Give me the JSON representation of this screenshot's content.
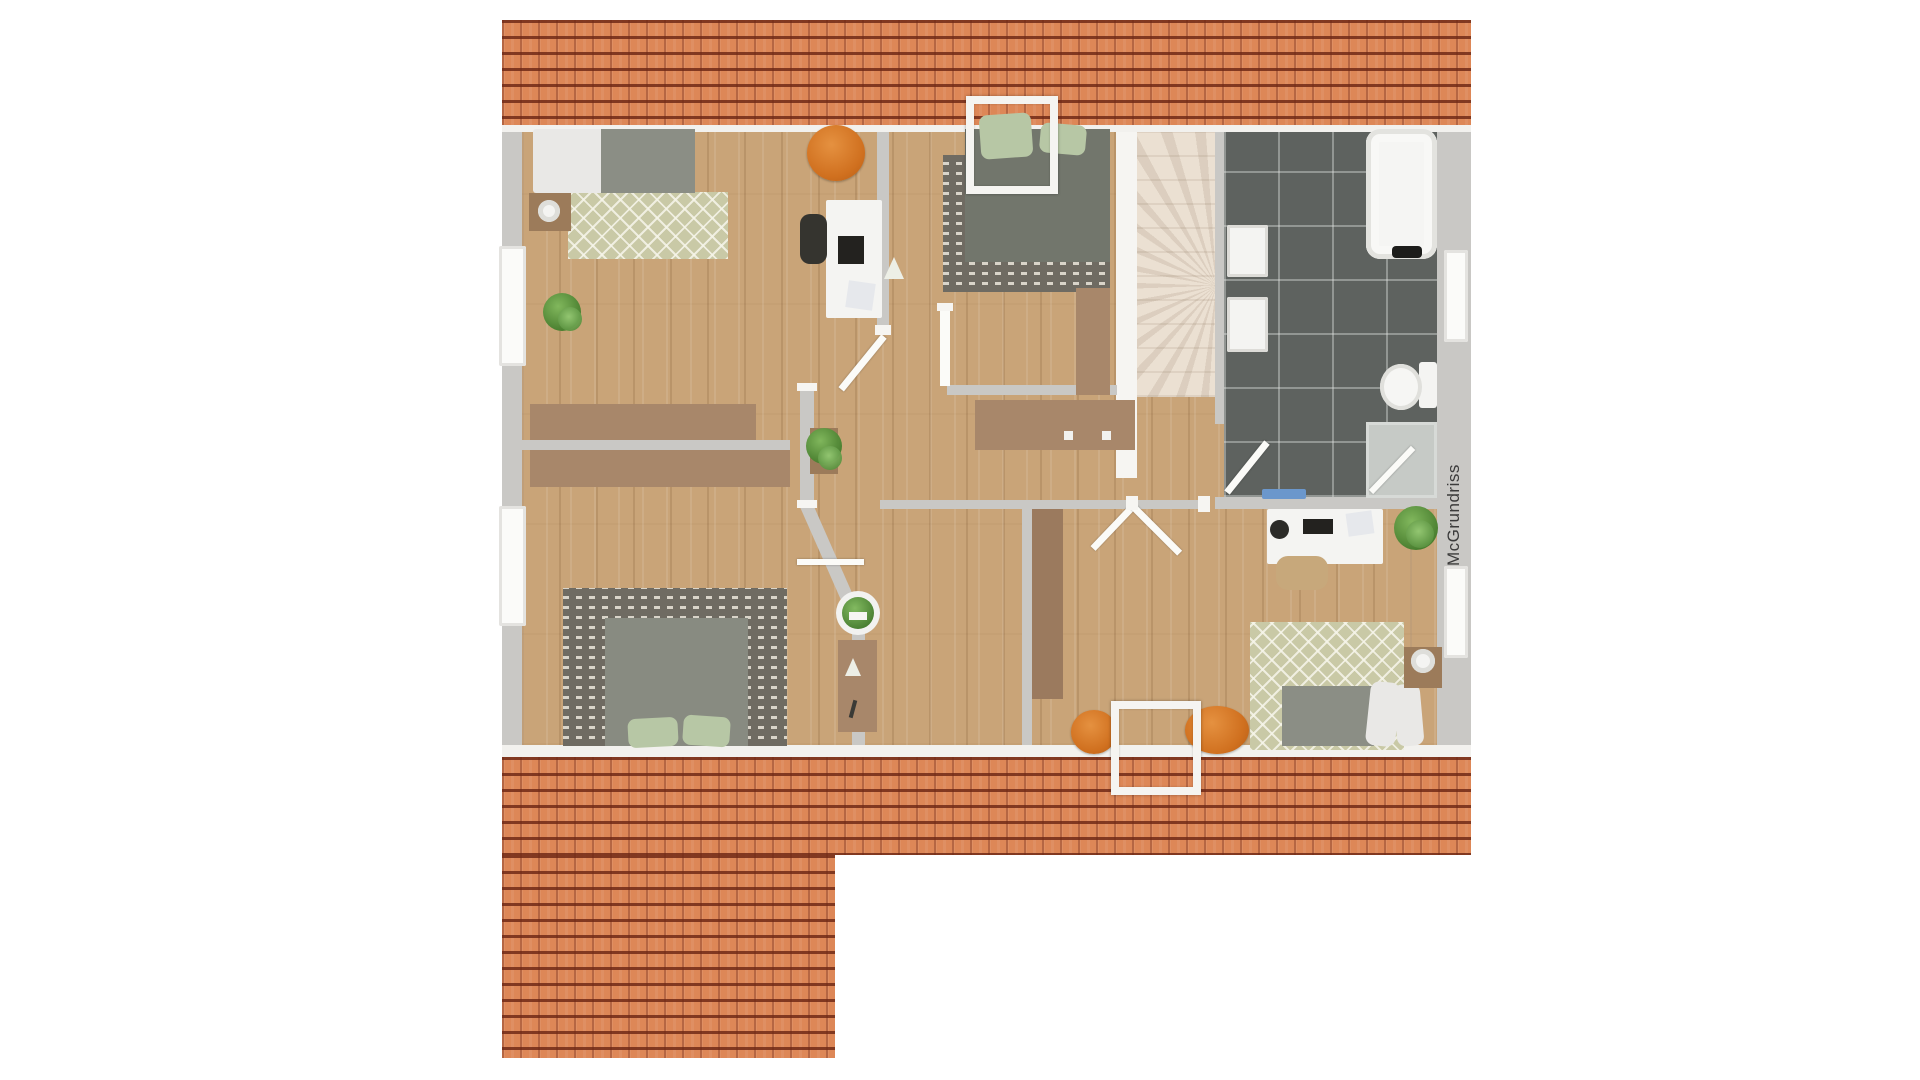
{
  "watermark": {
    "text": "McGrundriss"
  },
  "palette": {
    "background": "#ffffff",
    "roof_tile_orange": "#dd8757",
    "roof_line_dark": "#6d2614",
    "wall_gray": "#c9c8c5",
    "trim_white": "#f2f1ee",
    "wood_floor": "#c9a478",
    "furniture_wood": "#a8876a",
    "bath_tile_dark": "#5e625f",
    "stairs_cream": "#ebe0d2",
    "rug_green": "#c9c9a6",
    "rug_dark": "#6f6b62",
    "mattress_gray": "#8b8e85",
    "pillow_green": "#b7c7a5",
    "accent_orange_pouf": "#d0701f",
    "plant_green": "#447c2c",
    "bathmat_blue": "#6b97cc",
    "watermark_text": "#3b3b3b"
  },
  "scene": {
    "w": 1920,
    "h": 1080,
    "items": [
      {
        "t": "rect",
        "n": "roof-top",
        "x": 502,
        "y": 20,
        "w": 969,
        "h": 105,
        "c": "roof"
      },
      {
        "t": "rect",
        "n": "roof-top-trim",
        "x": 502,
        "y": 125,
        "w": 969,
        "h": 8,
        "f": "#f2f1ee"
      },
      {
        "t": "rect",
        "n": "floor-base",
        "x": 522,
        "y": 132,
        "w": 915,
        "h": 613,
        "c": "wood"
      },
      {
        "t": "rect",
        "n": "outer-wall-left",
        "x": 502,
        "y": 132,
        "w": 20,
        "h": 613,
        "c": "wall"
      },
      {
        "t": "rect",
        "n": "outer-wall-right",
        "x": 1437,
        "y": 132,
        "w": 34,
        "h": 613,
        "c": "wall"
      },
      {
        "t": "rect",
        "n": "floor-bottom-trim",
        "x": 502,
        "y": 745,
        "w": 969,
        "h": 12,
        "f": "#f2f1ee"
      },
      {
        "t": "rect",
        "n": "roof-bottom",
        "x": 502,
        "y": 757,
        "w": 969,
        "h": 98,
        "c": "roof"
      },
      {
        "t": "rect",
        "n": "roof-bottom-left-wing",
        "x": 502,
        "y": 855,
        "w": 333,
        "h": 203,
        "c": "roof"
      },
      {
        "t": "rect",
        "n": "staircase",
        "x": 1137,
        "y": 132,
        "w": 78,
        "h": 265,
        "c": "stairs"
      },
      {
        "t": "rect",
        "n": "stairs-side-wall",
        "x": 1116,
        "y": 132,
        "w": 21,
        "h": 346,
        "f": "#f6f5f2"
      },
      {
        "t": "rect",
        "n": "bathroom-floor",
        "x": 1224,
        "y": 132,
        "w": 213,
        "h": 365,
        "c": "tiles"
      },
      {
        "t": "rect",
        "n": "bathroom-wall-left",
        "x": 1215,
        "y": 132,
        "w": 9,
        "h": 292,
        "c": "wall"
      },
      {
        "t": "rect",
        "n": "bathroom-wall-bottom",
        "x": 1215,
        "y": 497,
        "w": 222,
        "h": 12,
        "c": "wall"
      },
      {
        "t": "rect",
        "n": "wall-bedroom1-right",
        "x": 877,
        "y": 132,
        "w": 12,
        "h": 200,
        "c": "wall"
      },
      {
        "t": "rect",
        "n": "wall-divider-left",
        "x": 522,
        "y": 440,
        "w": 268,
        "h": 10,
        "c": "wall"
      },
      {
        "t": "rect",
        "n": "wall-hall-mid",
        "x": 800,
        "y": 390,
        "w": 14,
        "h": 116,
        "c": "wall"
      },
      {
        "t": "line",
        "n": "wall-hall-angled",
        "x1": 806,
        "y1": 504,
        "x2": 858,
        "y2": 622,
        "sw": 13,
        "f": "#c9c8c5"
      },
      {
        "t": "rect",
        "n": "wall-hall-low",
        "x": 852,
        "y": 620,
        "w": 13,
        "h": 125,
        "c": "wall"
      },
      {
        "t": "rect",
        "n": "wall-bottom-rooms-top",
        "x": 880,
        "y": 500,
        "w": 330,
        "h": 9,
        "c": "wall"
      },
      {
        "t": "rect",
        "n": "wall-midroom-right",
        "x": 1022,
        "y": 509,
        "w": 10,
        "h": 236,
        "c": "wall"
      },
      {
        "t": "rect",
        "n": "wall-bedroom2-bottom",
        "x": 947,
        "y": 385,
        "w": 170,
        "h": 10,
        "c": "wall"
      },
      {
        "t": "rect",
        "n": "window-left-1",
        "x": 499,
        "y": 246,
        "w": 27,
        "h": 120,
        "c": "win"
      },
      {
        "t": "rect",
        "n": "window-left-2",
        "x": 499,
        "y": 506,
        "w": 27,
        "h": 120,
        "c": "win"
      },
      {
        "t": "rect",
        "n": "window-right-1",
        "x": 1444,
        "y": 250,
        "w": 24,
        "h": 92,
        "c": "win"
      },
      {
        "t": "rect",
        "n": "window-right-2",
        "x": 1444,
        "y": 566,
        "w": 24,
        "h": 92,
        "c": "win"
      },
      {
        "t": "rect",
        "n": "rug-bedroom1",
        "x": 568,
        "y": 192,
        "w": 160,
        "h": 67,
        "c": "rug-green"
      },
      {
        "t": "rect",
        "n": "bed1-duvet",
        "x": 533,
        "y": 129,
        "w": 70,
        "h": 64,
        "f": "#e9e8e6",
        "rx": 3
      },
      {
        "t": "rect",
        "n": "bed1-mattress",
        "x": 601,
        "y": 129,
        "w": 94,
        "h": 64,
        "f": "#8b8e85"
      },
      {
        "t": "rect",
        "n": "nightstand1",
        "x": 529,
        "y": 193,
        "w": 42,
        "h": 38,
        "f": "#9c7b5a"
      },
      {
        "t": "rect",
        "n": "lamp1",
        "x": 538,
        "y": 200,
        "w": 22,
        "h": 22,
        "c": "lamp",
        "rx": "50%"
      },
      {
        "t": "rect",
        "n": "plant1",
        "x": 543,
        "y": 293,
        "w": 38,
        "h": 38,
        "c": "plantball",
        "rx": "50%"
      },
      {
        "t": "rect",
        "n": "plant1-b",
        "x": 558,
        "y": 307,
        "w": 24,
        "h": 24,
        "c": "plantball2",
        "rx": "50%"
      },
      {
        "t": "rect",
        "n": "pouf1",
        "x": 807,
        "y": 125,
        "w": 58,
        "h": 56,
        "c": "pouf",
        "rx": "50%"
      },
      {
        "t": "rect",
        "n": "desk1",
        "x": 826,
        "y": 200,
        "w": 56,
        "h": 118,
        "f": "#f4f4f2",
        "rx": 2
      },
      {
        "t": "rect",
        "n": "chair1",
        "x": 800,
        "y": 214,
        "w": 27,
        "h": 50,
        "f": "#35342f",
        "rx": 10
      },
      {
        "t": "rect",
        "n": "laptop1",
        "x": 838,
        "y": 236,
        "w": 26,
        "h": 28,
        "f": "#23221f"
      },
      {
        "t": "tri",
        "n": "desk1-deco-triangle",
        "x": 884,
        "y": 257,
        "w": 20,
        "h": 22,
        "f": "#edefe6"
      },
      {
        "t": "rect",
        "n": "desk1-magazine",
        "x": 847,
        "y": 282,
        "w": 27,
        "h": 27,
        "f": "#e6e8ec",
        "rot": 8
      },
      {
        "t": "rect",
        "n": "rug-bedroom2",
        "x": 943,
        "y": 155,
        "w": 167,
        "h": 137,
        "c": "rug-dark"
      },
      {
        "t": "rect",
        "n": "bed2-mattress",
        "x": 965,
        "y": 129,
        "w": 145,
        "h": 133,
        "f": "#72766c"
      },
      {
        "t": "rect",
        "n": "bed2-pillow-a",
        "x": 980,
        "y": 114,
        "w": 52,
        "h": 44,
        "f": "#b7c7a5",
        "rx": 8,
        "rot": -4
      },
      {
        "t": "rect",
        "n": "bed2-pillow-b",
        "x": 1040,
        "y": 124,
        "w": 46,
        "h": 30,
        "f": "#b7c7a5",
        "rx": 8,
        "rot": 5
      },
      {
        "t": "rect",
        "n": "wardrobe2",
        "x": 1076,
        "y": 288,
        "w": 34,
        "h": 107,
        "f": "#a8876a"
      },
      {
        "t": "rect",
        "n": "door2-leaf",
        "x": 940,
        "y": 308,
        "w": 10,
        "h": 78,
        "f": "#fbfbf8"
      },
      {
        "t": "rect",
        "n": "hall-sideboard",
        "x": 975,
        "y": 400,
        "w": 160,
        "h": 50,
        "f": "#a8876a"
      },
      {
        "t": "rect",
        "n": "sideboard-knob-1",
        "x": 1064,
        "y": 431,
        "w": 9,
        "h": 9,
        "f": "#f1f1ee"
      },
      {
        "t": "rect",
        "n": "sideboard-knob-2",
        "x": 1102,
        "y": 431,
        "w": 9,
        "h": 9,
        "f": "#f1f1ee"
      },
      {
        "t": "rect",
        "n": "wardrobe-divider-top",
        "x": 530,
        "y": 404,
        "w": 226,
        "h": 36,
        "f": "#a8876a"
      },
      {
        "t": "rect",
        "n": "wardrobe-divider-bottom",
        "x": 530,
        "y": 450,
        "w": 260,
        "h": 37,
        "f": "#a8876a"
      },
      {
        "t": "rect",
        "n": "rug-bedroom3",
        "x": 563,
        "y": 588,
        "w": 224,
        "h": 158,
        "c": "rug-dark"
      },
      {
        "t": "rect",
        "n": "bed3-mattress",
        "x": 605,
        "y": 618,
        "w": 143,
        "h": 128,
        "f": "#888b81"
      },
      {
        "t": "rect",
        "n": "bed3-pillow-a",
        "x": 628,
        "y": 718,
        "w": 50,
        "h": 29,
        "f": "#b7c7a5",
        "rx": 8,
        "rot": -3
      },
      {
        "t": "rect",
        "n": "bed3-pillow-b",
        "x": 683,
        "y": 716,
        "w": 47,
        "h": 30,
        "f": "#b7c7a5",
        "rx": 8,
        "rot": 4
      },
      {
        "t": "rect",
        "n": "desk3",
        "x": 838,
        "y": 640,
        "w": 39,
        "h": 92,
        "f": "#a8876a"
      },
      {
        "t": "tri",
        "n": "desk3-deco-triangle",
        "x": 845,
        "y": 658,
        "w": 16,
        "h": 18,
        "f": "#edefe6"
      },
      {
        "t": "rect",
        "n": "desk3-pen",
        "x": 851,
        "y": 700,
        "w": 4,
        "h": 18,
        "f": "#3a3a36",
        "rot": 15
      },
      {
        "t": "rect",
        "n": "plant3-pot",
        "x": 836,
        "y": 591,
        "w": 44,
        "h": 44,
        "f": "#f2f2f0",
        "rx": "50%"
      },
      {
        "t": "rect",
        "n": "plant3",
        "x": 842,
        "y": 597,
        "w": 32,
        "h": 32,
        "c": "plantball",
        "rx": "50%"
      },
      {
        "t": "rect",
        "n": "hall-planter",
        "x": 810,
        "y": 428,
        "w": 28,
        "h": 46,
        "f": "#9c7b5a"
      },
      {
        "t": "rect",
        "n": "hall-plant",
        "x": 806,
        "y": 428,
        "w": 36,
        "h": 36,
        "c": "plantball",
        "rx": "50%"
      },
      {
        "t": "rect",
        "n": "hall-plant-b",
        "x": 818,
        "y": 446,
        "w": 24,
        "h": 24,
        "c": "plantball2",
        "rx": "50%"
      },
      {
        "t": "rect",
        "n": "wardrobe-midroom",
        "x": 1032,
        "y": 509,
        "w": 31,
        "h": 190,
        "f": "#9b7a5e"
      },
      {
        "t": "rect",
        "n": "bath-sink-1",
        "x": 1227,
        "y": 225,
        "w": 41,
        "h": 52,
        "c": "sink"
      },
      {
        "t": "rect",
        "n": "bath-sink-2",
        "x": 1227,
        "y": 297,
        "w": 41,
        "h": 55,
        "c": "sink"
      },
      {
        "t": "rect",
        "n": "bathtub",
        "x": 1366,
        "y": 129,
        "w": 71,
        "h": 130,
        "c": "tub"
      },
      {
        "t": "rect",
        "n": "bathtub-headrest",
        "x": 1392,
        "y": 246,
        "w": 30,
        "h": 12,
        "f": "#1d1d1b",
        "rx": 4
      },
      {
        "t": "rect",
        "n": "toilet-tank",
        "x": 1419,
        "y": 362,
        "w": 18,
        "h": 46,
        "f": "#f4f4f2",
        "rx": 3
      },
      {
        "t": "rect",
        "n": "toilet-bowl",
        "x": 1380,
        "y": 364,
        "w": 42,
        "h": 46,
        "f": "#f6f6f4",
        "c": "bowl",
        "rx": "50%"
      },
      {
        "t": "rect",
        "n": "shower",
        "x": 1366,
        "y": 422,
        "w": 71,
        "h": 76,
        "c": "shower"
      },
      {
        "t": "line",
        "n": "shower-door",
        "x1": 1371,
        "y1": 492,
        "x2": 1413,
        "y2": 448,
        "sw": 6
      },
      {
        "t": "rect",
        "n": "bath-mat",
        "x": 1262,
        "y": 489,
        "w": 44,
        "h": 10,
        "f": "#6b97cc",
        "rx": 2
      },
      {
        "t": "line",
        "n": "bathroom-door",
        "x1": 1227,
        "y1": 492,
        "x2": 1267,
        "y2": 442,
        "sw": 7
      },
      {
        "t": "line",
        "n": "bedroom1-door",
        "x1": 884,
        "y1": 336,
        "x2": 841,
        "y2": 389,
        "sw": 7
      },
      {
        "t": "line",
        "n": "hall-door-open",
        "x1": 797,
        "y1": 562,
        "x2": 864,
        "y2": 562,
        "sw": 6
      },
      {
        "t": "line",
        "n": "midroom-door",
        "x1": 1133,
        "y1": 506,
        "x2": 1093,
        "y2": 548,
        "sw": 7
      },
      {
        "t": "line",
        "n": "rightroom-door",
        "x1": 1133,
        "y1": 506,
        "x2": 1180,
        "y2": 553,
        "sw": 7
      },
      {
        "t": "rect",
        "n": "jamb-cap-1",
        "x": 875,
        "y": 325,
        "w": 16,
        "h": 10,
        "c": "cap"
      },
      {
        "t": "rect",
        "n": "jamb-cap-2",
        "x": 797,
        "y": 383,
        "w": 20,
        "h": 8,
        "c": "cap"
      },
      {
        "t": "rect",
        "n": "jamb-cap-3",
        "x": 797,
        "y": 500,
        "w": 20,
        "h": 8,
        "c": "cap"
      },
      {
        "t": "rect",
        "n": "jamb-cap-4",
        "x": 937,
        "y": 303,
        "w": 16,
        "h": 8,
        "c": "cap"
      },
      {
        "t": "rect",
        "n": "jamb-cap-5",
        "x": 1126,
        "y": 496,
        "w": 12,
        "h": 14,
        "c": "cap"
      },
      {
        "t": "rect",
        "n": "jamb-cap-6",
        "x": 1198,
        "y": 496,
        "w": 12,
        "h": 16,
        "c": "cap"
      },
      {
        "t": "rect",
        "n": "jamb-cap-7",
        "x": 849,
        "y": 612,
        "w": 18,
        "h": 8,
        "c": "cap"
      },
      {
        "t": "rect",
        "n": "desk4",
        "x": 1267,
        "y": 509,
        "w": 116,
        "h": 55,
        "f": "#f4f4f2",
        "rx": 2
      },
      {
        "t": "rect",
        "n": "desk4-speaker",
        "x": 1270,
        "y": 520,
        "w": 19,
        "h": 19,
        "f": "#2b2b28",
        "rx": "50%"
      },
      {
        "t": "rect",
        "n": "laptop4",
        "x": 1303,
        "y": 519,
        "w": 30,
        "h": 15,
        "f": "#23221f"
      },
      {
        "t": "rect",
        "n": "desk4-magazine",
        "x": 1347,
        "y": 512,
        "w": 26,
        "h": 23,
        "f": "#e6e8ec",
        "rot": -8
      },
      {
        "t": "rect",
        "n": "plant4",
        "x": 1394,
        "y": 506,
        "w": 44,
        "h": 44,
        "c": "plantball",
        "rx": "50%"
      },
      {
        "t": "rect",
        "n": "plant4-b",
        "x": 1406,
        "y": 520,
        "w": 28,
        "h": 28,
        "c": "plantball2",
        "rx": "50%"
      },
      {
        "t": "rect",
        "n": "chair4",
        "x": 1276,
        "y": 556,
        "w": 52,
        "h": 34,
        "f": "#c7a87b",
        "rx": 12
      },
      {
        "t": "rect",
        "n": "rug-bedroom4",
        "x": 1250,
        "y": 622,
        "w": 154,
        "h": 128,
        "c": "rug-green"
      },
      {
        "t": "rect",
        "n": "bed4-mattress",
        "x": 1282,
        "y": 686,
        "w": 92,
        "h": 60,
        "f": "#8b8e85"
      },
      {
        "t": "rect",
        "n": "bed4-pillow-a",
        "x": 1368,
        "y": 682,
        "w": 30,
        "h": 64,
        "f": "#e9e8e6",
        "rx": 9,
        "rot": 6
      },
      {
        "t": "rect",
        "n": "bed4-pillow-b",
        "x": 1395,
        "y": 684,
        "w": 27,
        "h": 62,
        "f": "#e9e8e6",
        "rx": 9,
        "rot": -5
      },
      {
        "t": "rect",
        "n": "nightstand4",
        "x": 1404,
        "y": 647,
        "w": 38,
        "h": 41,
        "f": "#9c7b5a"
      },
      {
        "t": "rect",
        "n": "lamp4",
        "x": 1411,
        "y": 649,
        "w": 24,
        "h": 24,
        "c": "lamp",
        "rx": "50%"
      },
      {
        "t": "rect",
        "n": "pouf2",
        "x": 1071,
        "y": 710,
        "w": 46,
        "h": 44,
        "c": "pouf",
        "rx": "50%"
      },
      {
        "t": "rect",
        "n": "pouf3",
        "x": 1185,
        "y": 706,
        "w": 64,
        "h": 48,
        "c": "pouf",
        "rx": "50%"
      },
      {
        "t": "rect",
        "n": "skylight-top",
        "x": 966,
        "y": 96,
        "w": 76,
        "h": 82,
        "c": "skylight"
      },
      {
        "t": "rect",
        "n": "skylight-bottom",
        "x": 1111,
        "y": 701,
        "w": 74,
        "h": 78,
        "c": "skylight"
      }
    ]
  }
}
